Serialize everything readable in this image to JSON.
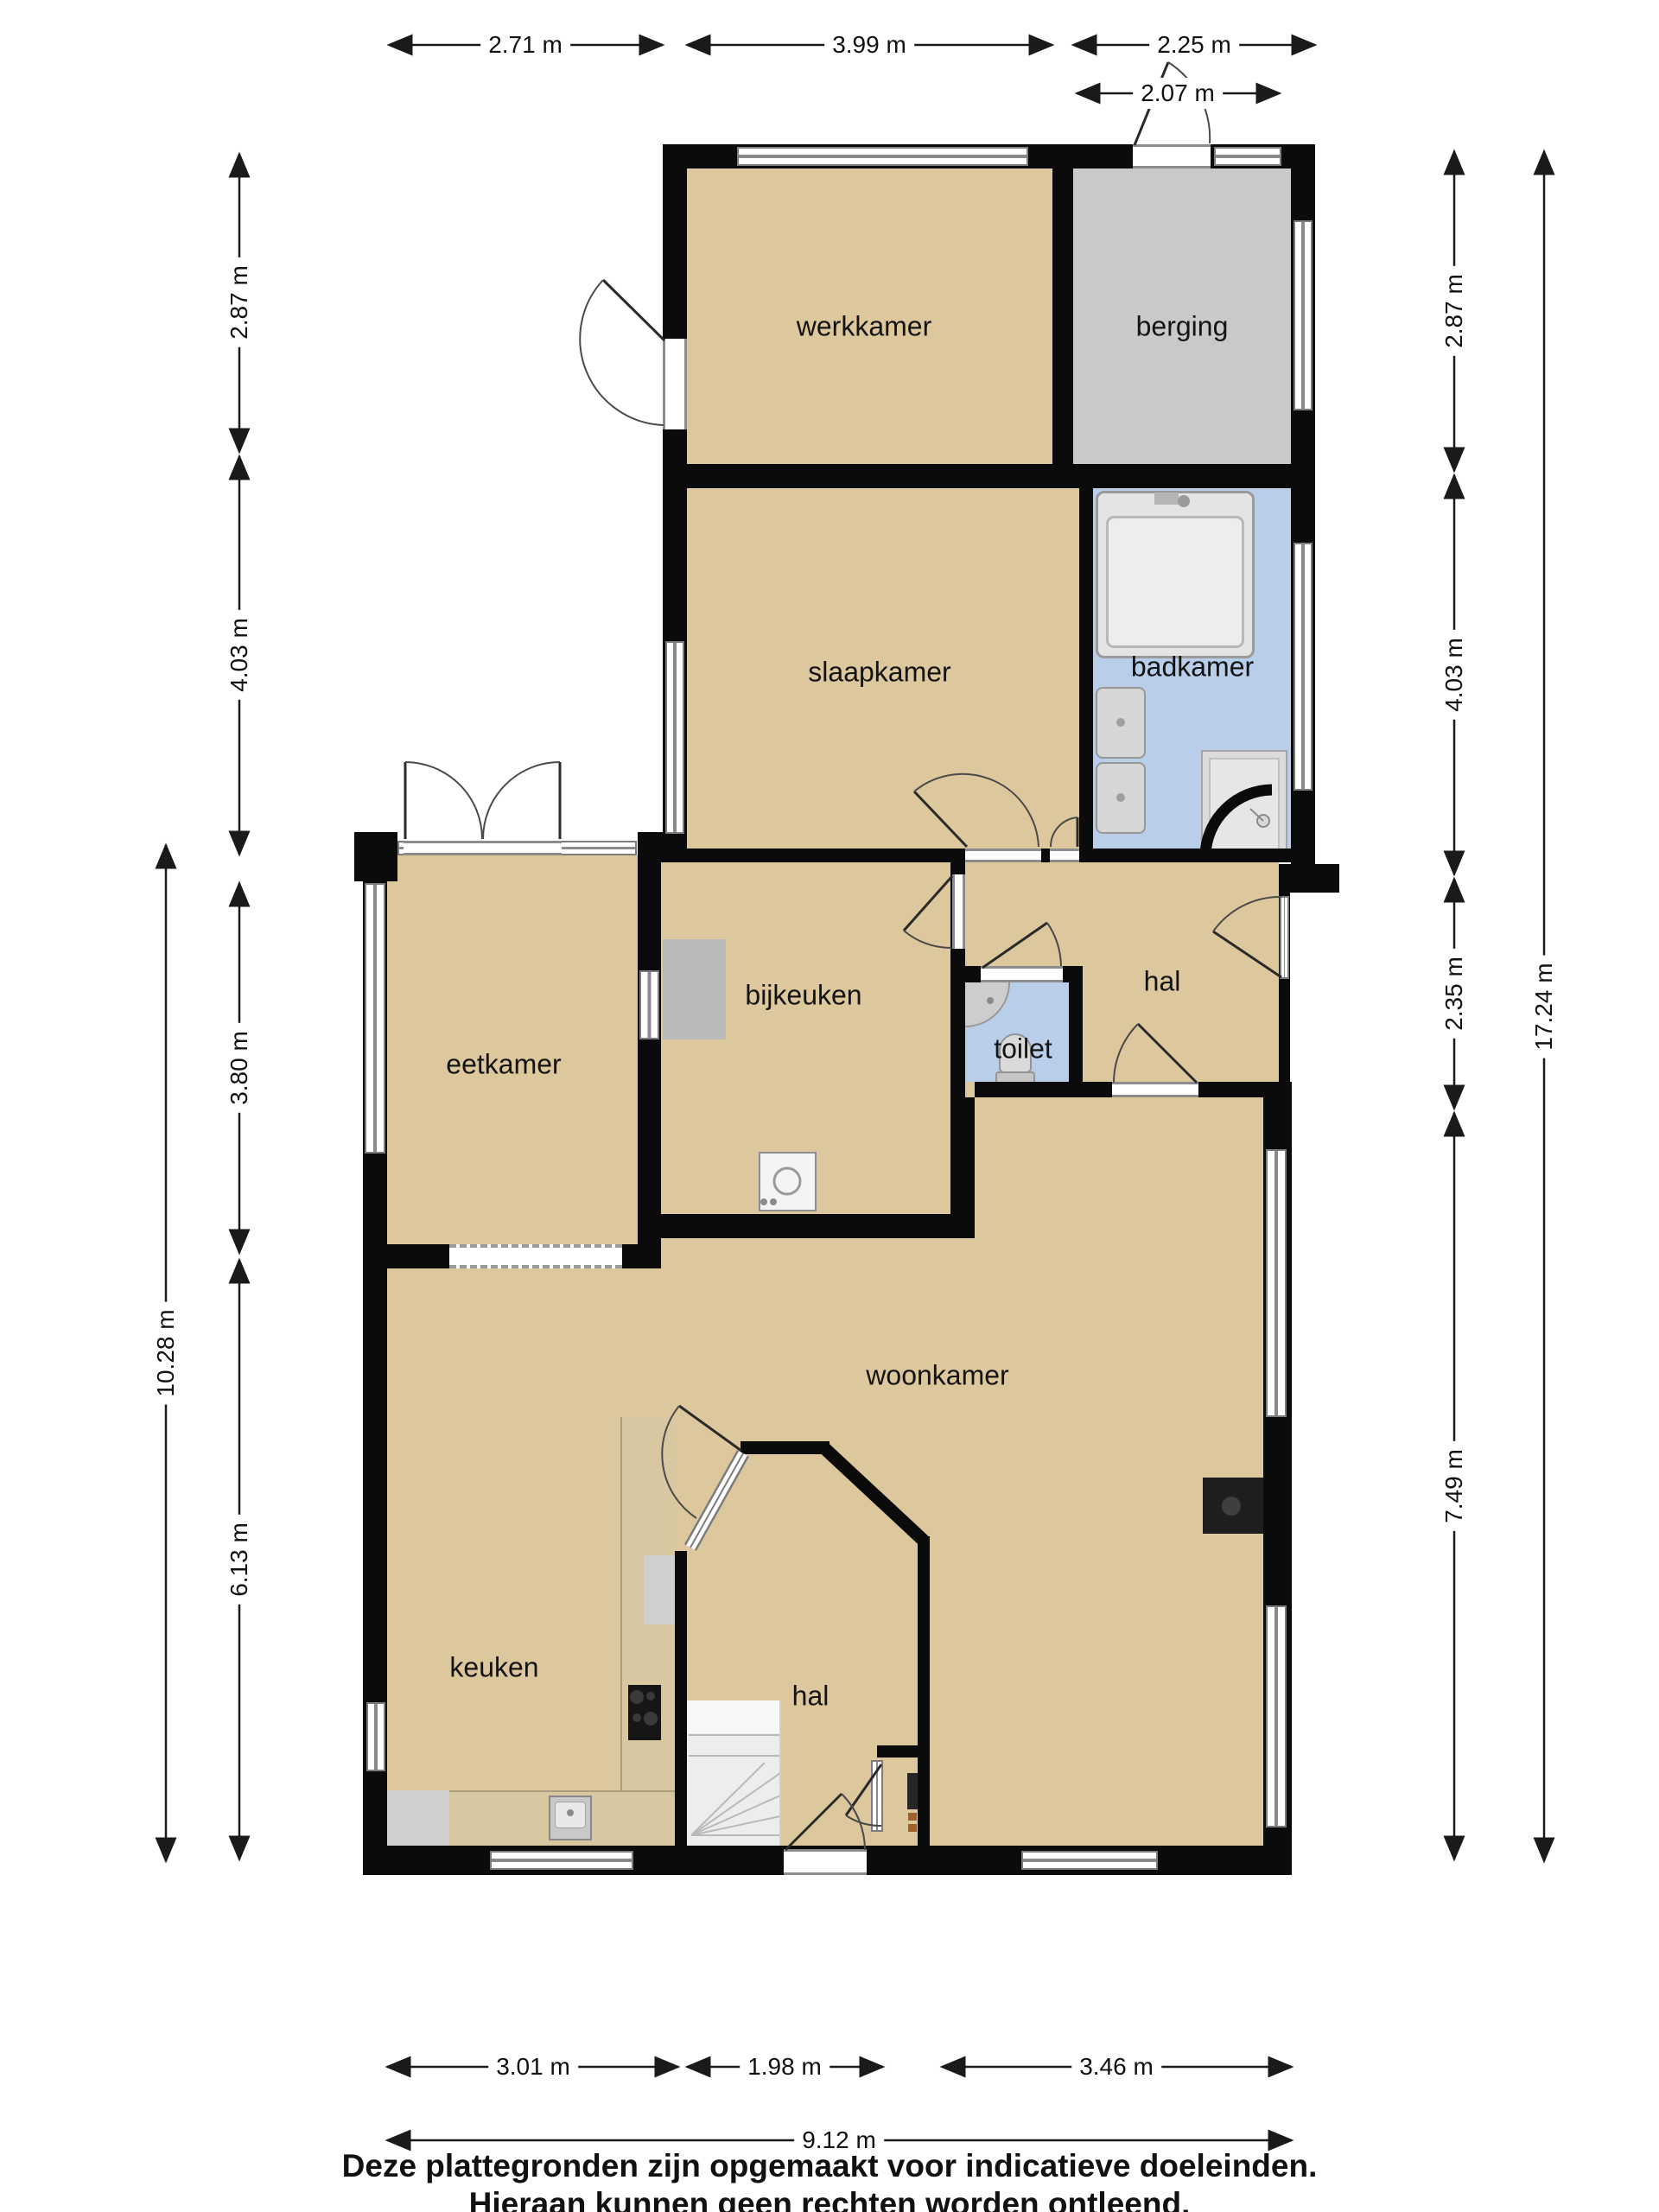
{
  "plan_title": "Begane grond plattegrond",
  "rooms": {
    "werkkamer": "werkkamer",
    "berging": "berging",
    "slaapkamer": "slaapkamer",
    "badkamer": "badkamer",
    "eetkamer": "eetkamer",
    "bijkeuken": "bijkeuken",
    "toilet": "toilet",
    "hal_boven": "hal",
    "woonkamer": "woonkamer",
    "keuken": "keuken",
    "hal_onder": "hal"
  },
  "dimensions": {
    "top": [
      "2.71 m",
      "3.99 m",
      "2.25 m"
    ],
    "top_sub": "2.07 m",
    "left": [
      "2.87 m",
      "4.03 m",
      "3.80 m",
      "6.13 m"
    ],
    "left_total": "10.28 m",
    "right": [
      "2.87 m",
      "4.03 m",
      "2.35 m",
      "7.49 m"
    ],
    "right_total": "17.24 m",
    "bottom": [
      "3.01 m",
      "1.98 m",
      "3.46 m"
    ],
    "bottom_total": "9.12 m"
  },
  "disclaimer": [
    "Deze plattegronden zijn opgemaakt voor indicatieve doeleinden.",
    "Hieraan kunnen geen rechten worden ontleend."
  ],
  "colors": {
    "floor": "#dcc89c",
    "wet_room": "#b8cee9",
    "storage": "#c9c9c9",
    "wall": "#0b0b0b",
    "counter_wood": "#d7c8a2"
  }
}
